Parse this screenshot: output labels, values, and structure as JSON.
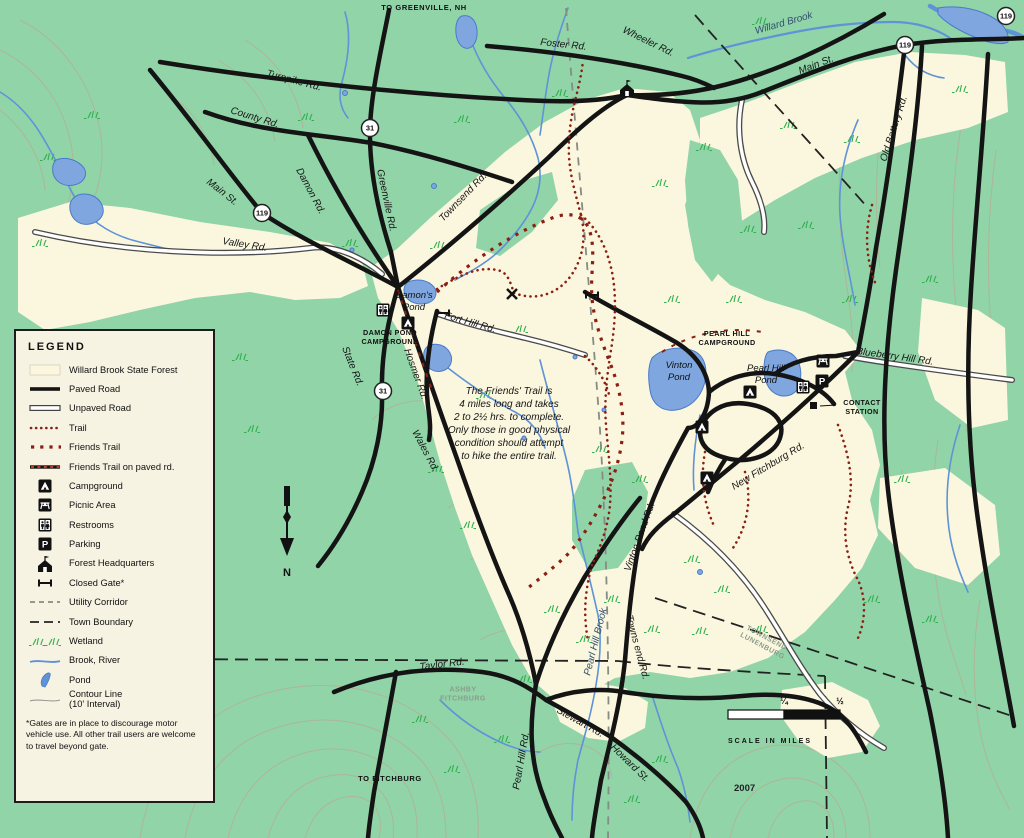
{
  "map_name": "Willard Brook State Forest trail map",
  "colors": {
    "background_green": "#90D4A8",
    "forest_cream": "#FBF7DE",
    "water_blue": "#5E93D8",
    "trail_maroon": "#8B1F14",
    "wetland_green": "#2FAF4D",
    "road_black": "#141414",
    "contour_tan": "#C2A28C"
  },
  "legend": {
    "title": "LEGEND",
    "items": [
      "Willard Brook State Forest",
      "Paved Road",
      "Unpaved Road",
      "Trail",
      "Friends Trail",
      "Friends Trail on paved rd.",
      "Campground",
      "Picnic Area",
      "Restrooms",
      "Parking",
      "Forest Headquarters",
      "Closed Gate*",
      "Utility Corridor",
      "Town Boundary",
      "Wetland",
      "Brook, River",
      "Pond",
      "Contour Line\n(10' Interval)"
    ],
    "footnote": "*Gates are in place to discourage motor vehicle use. All other trail users are welcome to travel beyond gate."
  },
  "note": "The Friends' Trail is\n4 miles long and takes\n2 to 2½ hrs. to complete.\nOnly those in good physical\ncondition should attempt\nto hike the entire trail.",
  "labels": {
    "to_greenville": "TO GREENVILLE, NH",
    "foster_rd": "Foster Rd.",
    "wheeler_rd": "Wheeler Rd.",
    "willard_brook": "Willard Brook",
    "main_st_e": "Main St.",
    "old_battery_rd": "Old Battery Rd.",
    "turnpike_rd": "Turnpike Rd.",
    "county_rd": "County Rd.",
    "main_st_w": "Main St.",
    "valley_rd": "Valley Rd.",
    "damon_rd": "Damon Rd.",
    "greenville_rd": "Greenville Rd.",
    "townsend_rd": "Townsend Rd.",
    "state_rd": "State Rd.",
    "fort_hill_rd": "Fort Hill Rd.",
    "hosmer_rd": "Hosmer Rd.",
    "wales_rd": "Wales Rd.",
    "damons_pond": "Damon's\nPond",
    "damon_campground": "DAMON POND\nCAMPGROUND",
    "pearl_hill_campground": "PEARL HILL\nCAMPGROUND",
    "vinton_pond": "Vinton\nPond",
    "pearl_hill_pond": "Pearl Hill\nPond",
    "contact_station": "CONTACT\nSTATION",
    "blueberry_hill_rd": "Blueberry Hill Rd.",
    "new_fitchburg_rd": "New Fitchburg Rd.",
    "vinton_pond_rd": "Vinton Pond Rd.",
    "pearl_hill_brook": "Pearl Hill Brook",
    "towns_end_rd": "Towns end Rd.",
    "taylor_rd": "Taylor Rd.",
    "pearl_hill_rd": "Pearl Hill Rd.",
    "stewart_rd": "Stewart Rd.",
    "howard_st": "Howard St.",
    "to_fitchburg": "TO FITCHBURG",
    "boundary_ashby_fitchburg": "ASHBY\nFITCHBURG",
    "boundary_townsend_lunenburg": "TOWNSEND\nLUNENBURG",
    "compass_n": "N",
    "year": "2007"
  },
  "shields": {
    "r119_w": "119",
    "r31_n": "31",
    "r31_s": "31",
    "r119_e": "119",
    "r119_corner": "119"
  },
  "scale": {
    "quarter": "¼",
    "half": "½",
    "caption": "SCALE IN MILES"
  }
}
